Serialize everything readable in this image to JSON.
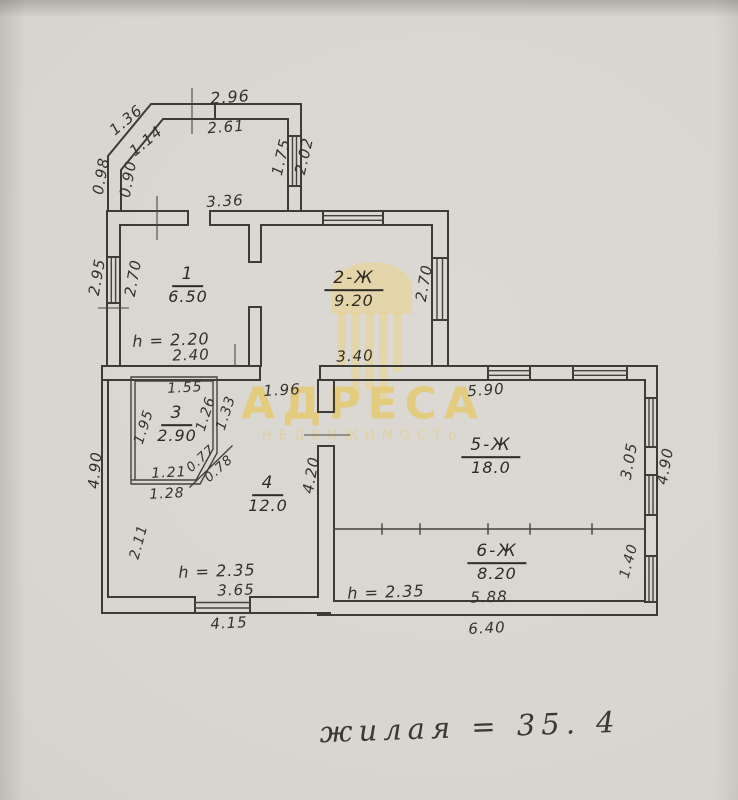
{
  "watermark": {
    "brand": "АДРЕСА",
    "subtitle": "НЕДВИЖИМОСТЬ"
  },
  "note": {
    "text": "жилая = 35. 4"
  },
  "plan": {
    "rooms": [
      {
        "id": "1",
        "area": "6.50",
        "x": 188,
        "y": 286
      },
      {
        "id": "2-Ж",
        "area": "9.20",
        "x": 354,
        "y": 290
      },
      {
        "id": "3",
        "area": "2.90",
        "x": 177,
        "y": 425
      },
      {
        "id": "4",
        "area": "12.0",
        "x": 268,
        "y": 495
      },
      {
        "id": "5-Ж",
        "area": "18.0",
        "x": 491,
        "y": 457
      },
      {
        "id": "6-Ж",
        "area": "8.20",
        "x": 497,
        "y": 563
      }
    ],
    "dimensions": [
      {
        "t": "2.96",
        "x": 230,
        "y": 97,
        "r": -4,
        "s": 16
      },
      {
        "t": "2.61",
        "x": 226,
        "y": 127,
        "r": -4,
        "s": 15
      },
      {
        "t": "1.36",
        "x": 126,
        "y": 120,
        "r": -40,
        "s": 15
      },
      {
        "t": "1.14",
        "x": 146,
        "y": 141,
        "r": -40,
        "s": 15
      },
      {
        "t": "0.98",
        "x": 101,
        "y": 176,
        "r": -80,
        "s": 15
      },
      {
        "t": "0.90",
        "x": 128,
        "y": 179,
        "r": -80,
        "s": 15
      },
      {
        "t": "1.75",
        "x": 281,
        "y": 157,
        "r": -77,
        "s": 15
      },
      {
        "t": "2.02",
        "x": 304,
        "y": 156,
        "r": -77,
        "s": 15
      },
      {
        "t": "3.36",
        "x": 225,
        "y": 201,
        "r": -3,
        "s": 15
      },
      {
        "t": "2.95",
        "x": 97,
        "y": 277,
        "r": -80,
        "s": 15
      },
      {
        "t": "2.70",
        "x": 133,
        "y": 278,
        "r": -80,
        "s": 15
      },
      {
        "t": "2.70",
        "x": 424,
        "y": 283,
        "r": -80,
        "s": 15
      },
      {
        "t": "h = 2.20",
        "x": 171,
        "y": 340,
        "r": -2,
        "s": 16
      },
      {
        "t": "2.40",
        "x": 191,
        "y": 355,
        "r": -2,
        "s": 15
      },
      {
        "t": "3.40",
        "x": 355,
        "y": 356,
        "r": -2,
        "s": 15
      },
      {
        "t": "1.55",
        "x": 185,
        "y": 388,
        "r": -3,
        "s": 14
      },
      {
        "t": "1.95",
        "x": 144,
        "y": 427,
        "r": -72,
        "s": 14
      },
      {
        "t": "1.26",
        "x": 206,
        "y": 414,
        "r": -72,
        "s": 14
      },
      {
        "t": "1.33",
        "x": 226,
        "y": 413,
        "r": -72,
        "s": 14
      },
      {
        "t": "0.77",
        "x": 201,
        "y": 459,
        "r": -42,
        "s": 13
      },
      {
        "t": "0.78",
        "x": 219,
        "y": 469,
        "r": -42,
        "s": 13
      },
      {
        "t": "1.21",
        "x": 169,
        "y": 473,
        "r": -3,
        "s": 14
      },
      {
        "t": "1.28",
        "x": 167,
        "y": 494,
        "r": -3,
        "s": 14
      },
      {
        "t": "1.96",
        "x": 282,
        "y": 390,
        "r": -3,
        "s": 15
      },
      {
        "t": "4.20",
        "x": 311,
        "y": 475,
        "r": -80,
        "s": 15
      },
      {
        "t": "4.90",
        "x": 95,
        "y": 470,
        "r": -85,
        "s": 15
      },
      {
        "t": "2.11",
        "x": 139,
        "y": 542,
        "r": -75,
        "s": 14
      },
      {
        "t": "h = 2.35",
        "x": 217,
        "y": 571,
        "r": -2,
        "s": 16
      },
      {
        "t": "3.65",
        "x": 236,
        "y": 590,
        "r": -2,
        "s": 15
      },
      {
        "t": "4.15",
        "x": 229,
        "y": 623,
        "r": -3,
        "s": 15
      },
      {
        "t": "5.90",
        "x": 486,
        "y": 390,
        "r": -4,
        "s": 15
      },
      {
        "t": "3.05",
        "x": 629,
        "y": 461,
        "r": -80,
        "s": 15
      },
      {
        "t": "4.90",
        "x": 665,
        "y": 466,
        "r": -80,
        "s": 15
      },
      {
        "t": "h = 2.35",
        "x": 386,
        "y": 592,
        "r": -2,
        "s": 16
      },
      {
        "t": "5.88",
        "x": 489,
        "y": 597,
        "r": -2,
        "s": 15
      },
      {
        "t": "6.40",
        "x": 487,
        "y": 628,
        "r": -3,
        "s": 15
      },
      {
        "t": "1.40",
        "x": 629,
        "y": 561,
        "r": -75,
        "s": 14
      }
    ]
  }
}
